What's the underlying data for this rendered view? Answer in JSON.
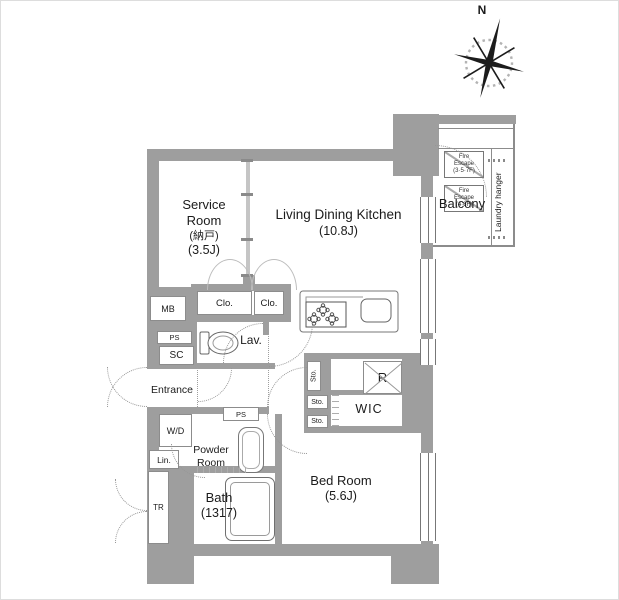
{
  "colors": {
    "wall": "#9e9e9e",
    "partition": "#c5c5c5",
    "text": "#1b1b1b"
  },
  "compass": {
    "north_label": "N"
  },
  "rooms": {
    "service_room": {
      "name": "Service Room",
      "kanji": "(納戸)",
      "size": "(3.5J)"
    },
    "ldk": {
      "name": "Living Dining Kitchen",
      "size": "(10.8J)"
    },
    "bedroom": {
      "name": "Bed Room",
      "size": "(5.6J)"
    },
    "bath": {
      "name": "Bath",
      "size": "(1317)"
    },
    "powder_room": {
      "name": "Powder Room"
    },
    "entrance": {
      "name": "Entrance"
    },
    "wic": {
      "name": "WIC"
    },
    "lav": {
      "name": "Lav."
    },
    "balcony": {
      "name": "Balcony",
      "laundry_hanger": "Laundry hanger"
    }
  },
  "fire_escapes": {
    "upper": {
      "line1": "Fire",
      "line2": "Escape",
      "line3": "(3·5·7F)"
    },
    "lower": {
      "line1": "Fire",
      "line2": "Escape",
      "line3": "(4·6F)"
    }
  },
  "fixtures": {
    "mb": "MB",
    "ps_upper": "PS",
    "sc": "SC",
    "clo_left": "Clo.",
    "clo_right": "Clo.",
    "wd": "W/D",
    "lin": "Lin.",
    "ps_lower": "PS",
    "tr": "TR",
    "sto_vertical": "Sto.",
    "sto_middle": "Sto.",
    "sto_lower": "Sto.",
    "refrigerator": "R"
  }
}
